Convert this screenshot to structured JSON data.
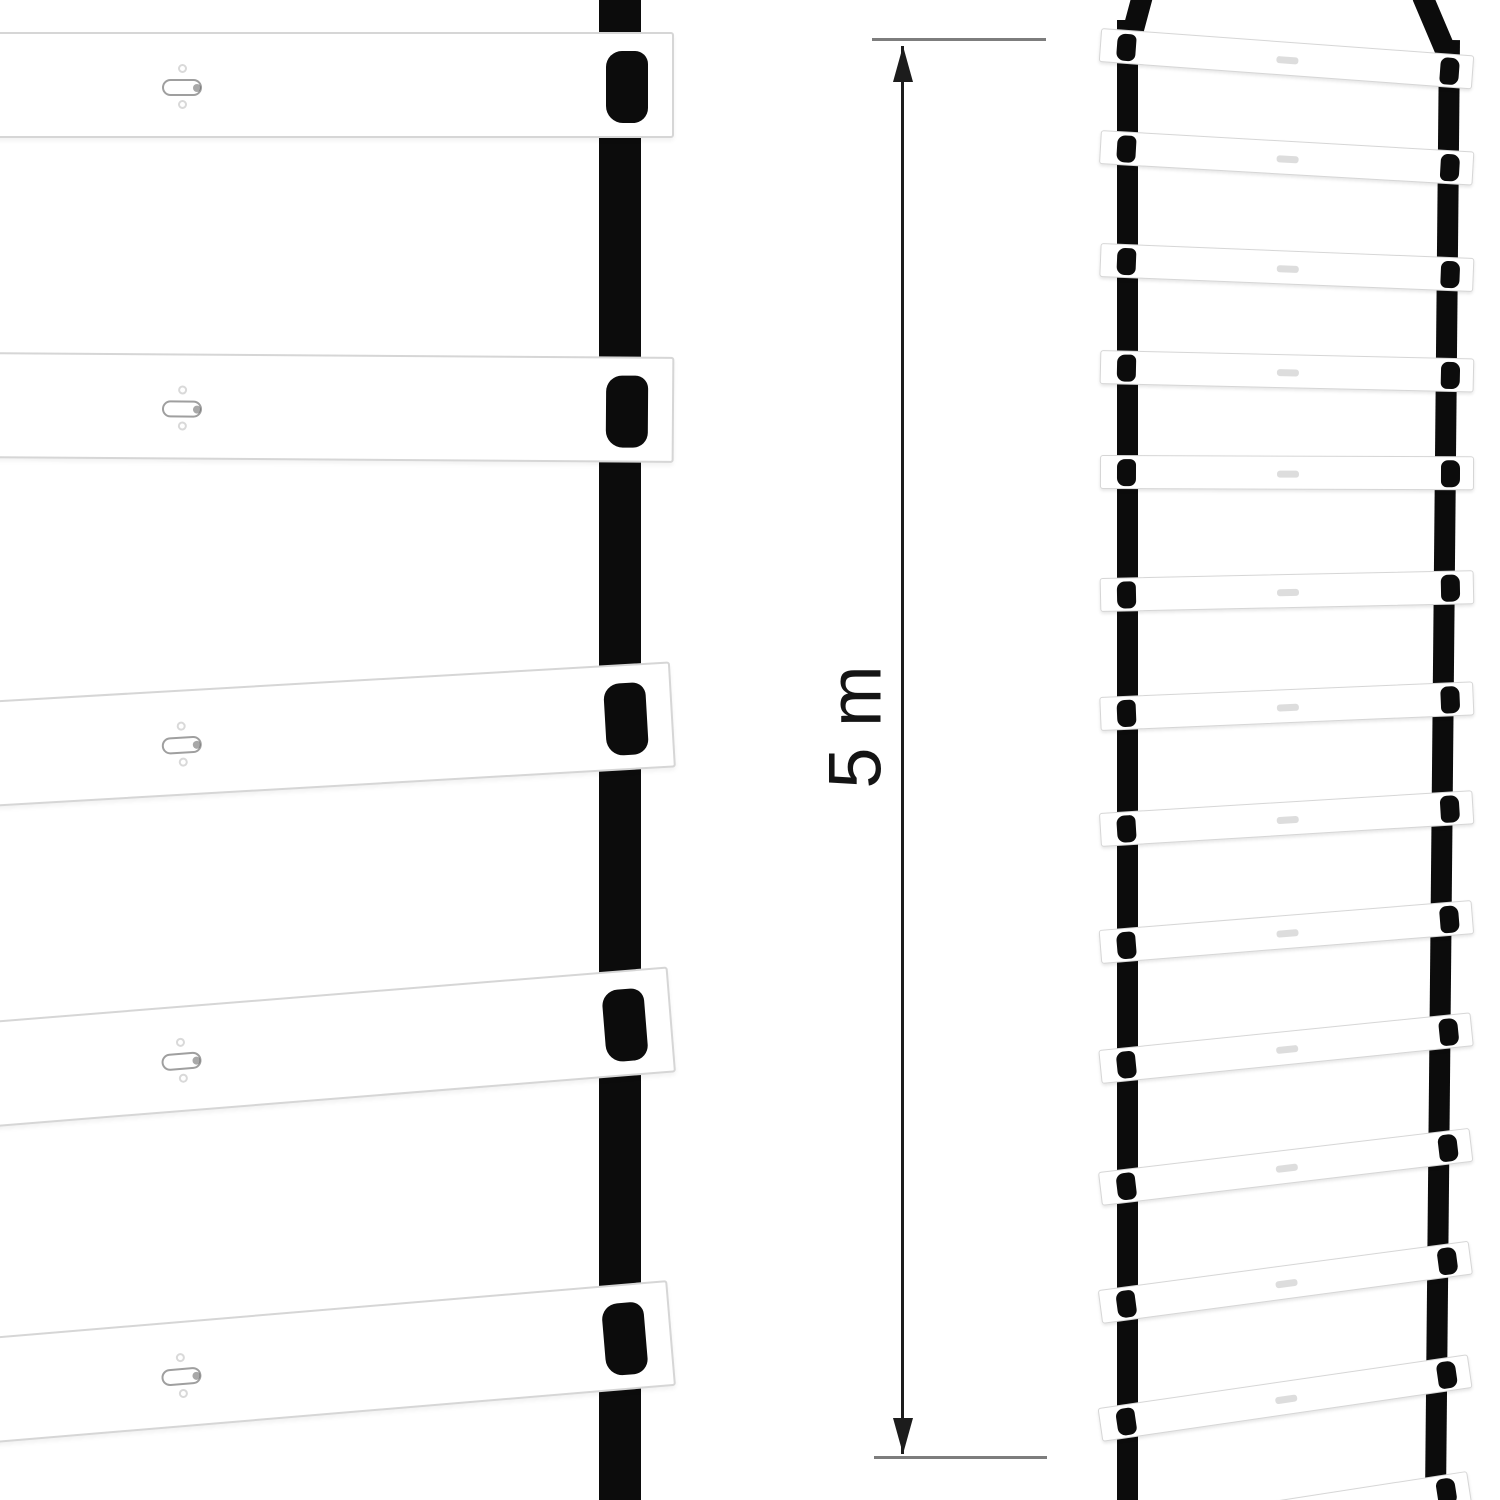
{
  "canvas": {
    "width": 1500,
    "height": 1500,
    "background": "#ffffff"
  },
  "colors": {
    "strap": "#0c0c0c",
    "rung_fill": "#ffffff",
    "rung_border": "#d6d6d6",
    "slot_border": "#9f9f9f",
    "slot_tip": "#606060",
    "dot_border": "#d9d9d9",
    "center_mark": "#d4d4d4",
    "ext_line": "#7d7d7d",
    "dim_line": "#1c1c1c",
    "label": "#141414"
  },
  "dimension": {
    "label": "5 m",
    "font_size": 74,
    "label_cx": 855,
    "label_cy": 727,
    "line_x": 901,
    "line_w": 3,
    "arrow_top_tip_y": 46,
    "arrow_bottom_tip_y": 1454,
    "arrow_w": 20,
    "arrow_h": 36,
    "ext_top": {
      "x": 872,
      "y": 38,
      "w": 174,
      "h": 3
    },
    "ext_bottom": {
      "x": 874,
      "y": 1456,
      "w": 173,
      "h": 3
    }
  },
  "left_ladder": {
    "strap": {
      "x": 599,
      "top": 0,
      "w": 42,
      "h": 1500
    },
    "rung": {
      "x": -32,
      "w": 706,
      "h": 106
    },
    "slot": {
      "x": 192,
      "y": 45,
      "w": 40,
      "h": 17
    },
    "dot": {
      "x": 208,
      "top": 30,
      "bottom": 66,
      "size": 9
    },
    "blob": {
      "x": 636,
      "y": 17,
      "w": 42,
      "h": 72
    },
    "rungs": [
      {
        "top": 32,
        "tilt": 0
      },
      {
        "top": 352,
        "tilt": 0.4
      },
      {
        "top": 702,
        "tilt": -3.3
      },
      {
        "top": 1023,
        "tilt": -4.6
      },
      {
        "top": 1339,
        "tilt": -4.8
      }
    ]
  },
  "right_ladder": {
    "left_strap": {
      "x": 1117,
      "top": 20,
      "w": 21,
      "h": 1480,
      "lean": 0
    },
    "right_strap": {
      "x": 1439,
      "top": 40,
      "w": 21,
      "h": 1460,
      "lean": 0.55
    },
    "left_strap_top": {
      "x": 1118,
      "y": -10,
      "w": 21,
      "h": 58,
      "angle": 15
    },
    "right_strap_top": {
      "x": 1439,
      "y": -14,
      "w": 21,
      "h": 74,
      "angle": -23
    },
    "rung": {
      "x": 1100,
      "w": 374,
      "h": 34
    },
    "blob": {
      "left_x": 16,
      "right_x": 340,
      "w": 19,
      "h": 27,
      "y": 3
    },
    "center_mark": {
      "x": 176,
      "w": 22,
      "h": 7
    },
    "rungs": [
      {
        "top": 28,
        "tilt": 4.2
      },
      {
        "top": 130,
        "tilt": 3.3
      },
      {
        "top": 243,
        "tilt": 2.3
      },
      {
        "top": 350,
        "tilt": 1.3
      },
      {
        "top": 455,
        "tilt": 0.2
      },
      {
        "top": 578,
        "tilt": -1.2
      },
      {
        "top": 697,
        "tilt": -2.4
      },
      {
        "top": 813,
        "tilt": -3.5
      },
      {
        "top": 930,
        "tilt": -4.6
      },
      {
        "top": 1050,
        "tilt": -5.8
      },
      {
        "top": 1172,
        "tilt": -6.8
      },
      {
        "top": 1290,
        "tilt": -7.6
      },
      {
        "top": 1408,
        "tilt": -8.3
      },
      {
        "top": 1528,
        "tilt": -8.8
      }
    ]
  }
}
